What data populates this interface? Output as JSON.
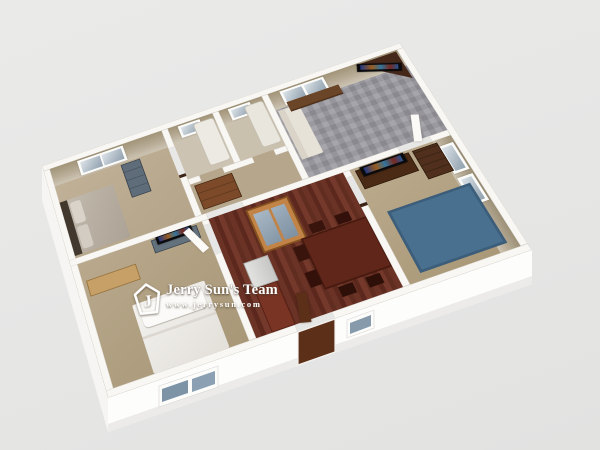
{
  "scene": {
    "type": "3d-dollhouse-floorplan-render",
    "background_color": "#e6e6e5",
    "exterior_wall_color": "#fcfcfb",
    "interior_wall_face_color": "#b8ac97",
    "watermark": {
      "logo_letter": "J",
      "logo_shape": "pentagon-outline",
      "team_name": "Jerry Sun's Team",
      "website": "www.jerrysun.com",
      "text_color": "#ffffff"
    },
    "rooms": [
      {
        "name": "bedroom-top-left",
        "floor": "tan carpet",
        "floor_color": "#b9a98f",
        "furniture": [
          "double-bed-gray-bedding",
          "dark-headboard",
          "slate-blue-dresser",
          "double-window"
        ]
      },
      {
        "name": "bathroom-left",
        "floor_color": "#ccc3b2",
        "furniture": [
          "bathtub",
          "small-window"
        ]
      },
      {
        "name": "bathroom-right",
        "floor_color": "#ccc3b2",
        "furniture": [
          "bathtub",
          "small-window"
        ]
      },
      {
        "name": "living-room",
        "floor": "gray parquet carpet",
        "floor_color": "#9a99a0",
        "furniture": [
          "corner-tv-stand",
          "flat-screen-tv",
          "wood-bench",
          "white-sofa",
          "double-window",
          "open-white-door"
        ]
      },
      {
        "name": "hallway",
        "floor_color": "#b5a68c",
        "furniture": [
          "wood-dresser",
          "dark-door-frames"
        ]
      },
      {
        "name": "dining-kitchen",
        "floor": "dark hardwood planks",
        "floor_color": "#66ывает2f23",
        "furniture": [
          "oak-display-cabinet-glass-doors",
          "refrigerator",
          "red-brown-counter",
          "dark-dining-table",
          "dark-chairs",
          "front-door-open"
        ]
      },
      {
        "name": "bedroom-right",
        "floor_color": "#b3a284",
        "furniture": [
          "dark-desk-with-tv",
          "tall-wood-chest",
          "blue-area-rug",
          "double-window-east-wall"
        ]
      },
      {
        "name": "bedroom-bottom",
        "floor_color": "#b0a085",
        "furniture": [
          "white-bed",
          "light-wood-desk",
          "blue-tv-stand-with-tv",
          "open-white-door"
        ]
      }
    ],
    "exterior_features": [
      "front-double-window-blue-glass",
      "front-door-dark-brown",
      "front-small-window"
    ],
    "palette": {
      "carpet_tan": "#b3a488",
      "hardwood": "#662f23",
      "wood_dark": "#4a2a16",
      "wood_oak": "#c28347",
      "rug_blue": "#4a6f8c",
      "tv_black": "#0b0b0e",
      "glass_blue": "#8fa0ae"
    }
  }
}
